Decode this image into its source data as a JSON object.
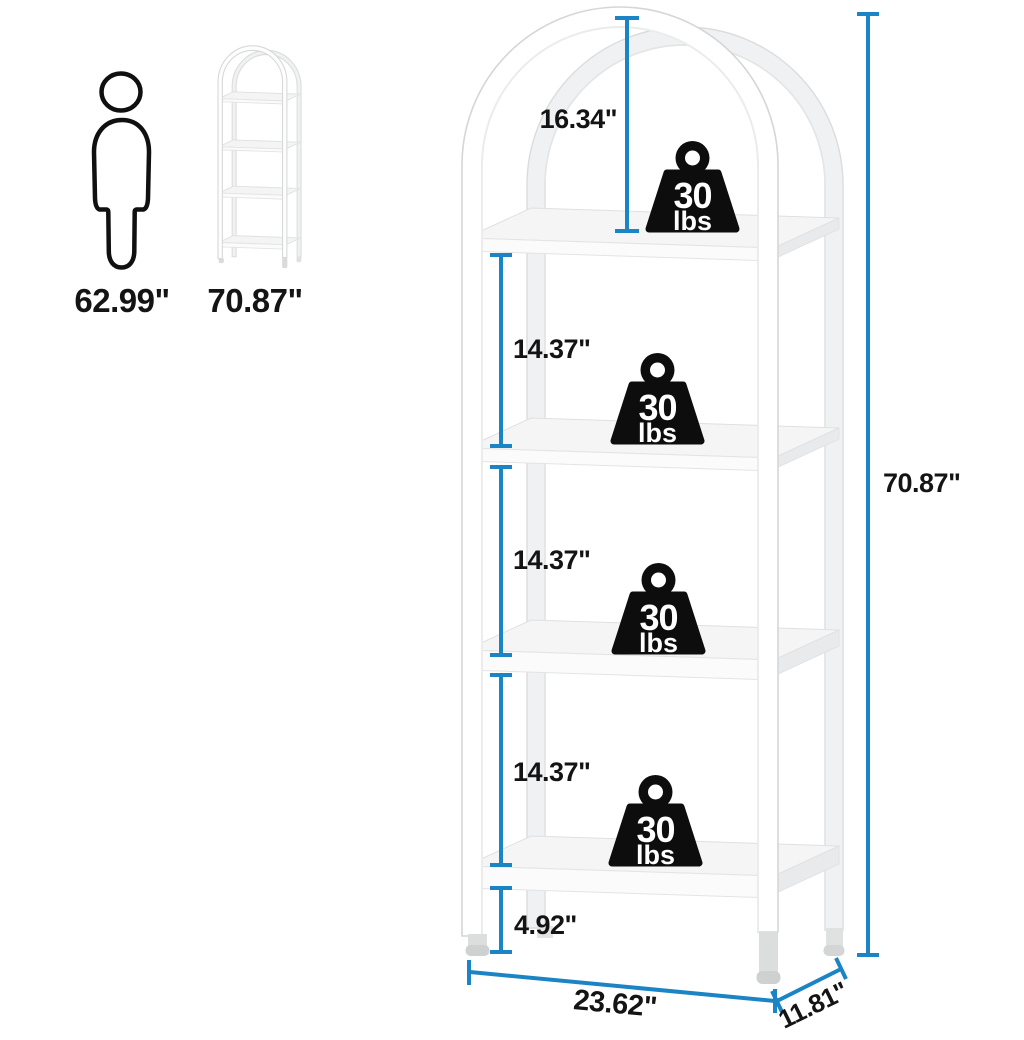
{
  "diagram": {
    "description": "Arched 4-tier bookshelf with dimension annotations and per-shelf weight capacity"
  },
  "colors": {
    "dimension_line_blue": "#1B84C5",
    "label_text": "#141414",
    "weight_badge": "#0d0d0d",
    "frame_white": "#ffffff",
    "back_frame_gray": "#f0f1f2"
  },
  "reference": {
    "person_height": "62.99\"",
    "product_height": "70.87\""
  },
  "measurements": {
    "top_section": "16.34\"",
    "section_2": "14.37\"",
    "section_3": "14.37\"",
    "section_4": "14.37\"",
    "bottom_clearance": "4.92\"",
    "overall_height": "70.87\"",
    "width": "23.62\"",
    "depth": "11.81\""
  },
  "capacity": {
    "per_shelf_value": "30",
    "per_shelf_unit": "lbs",
    "shelf_count": 4
  }
}
